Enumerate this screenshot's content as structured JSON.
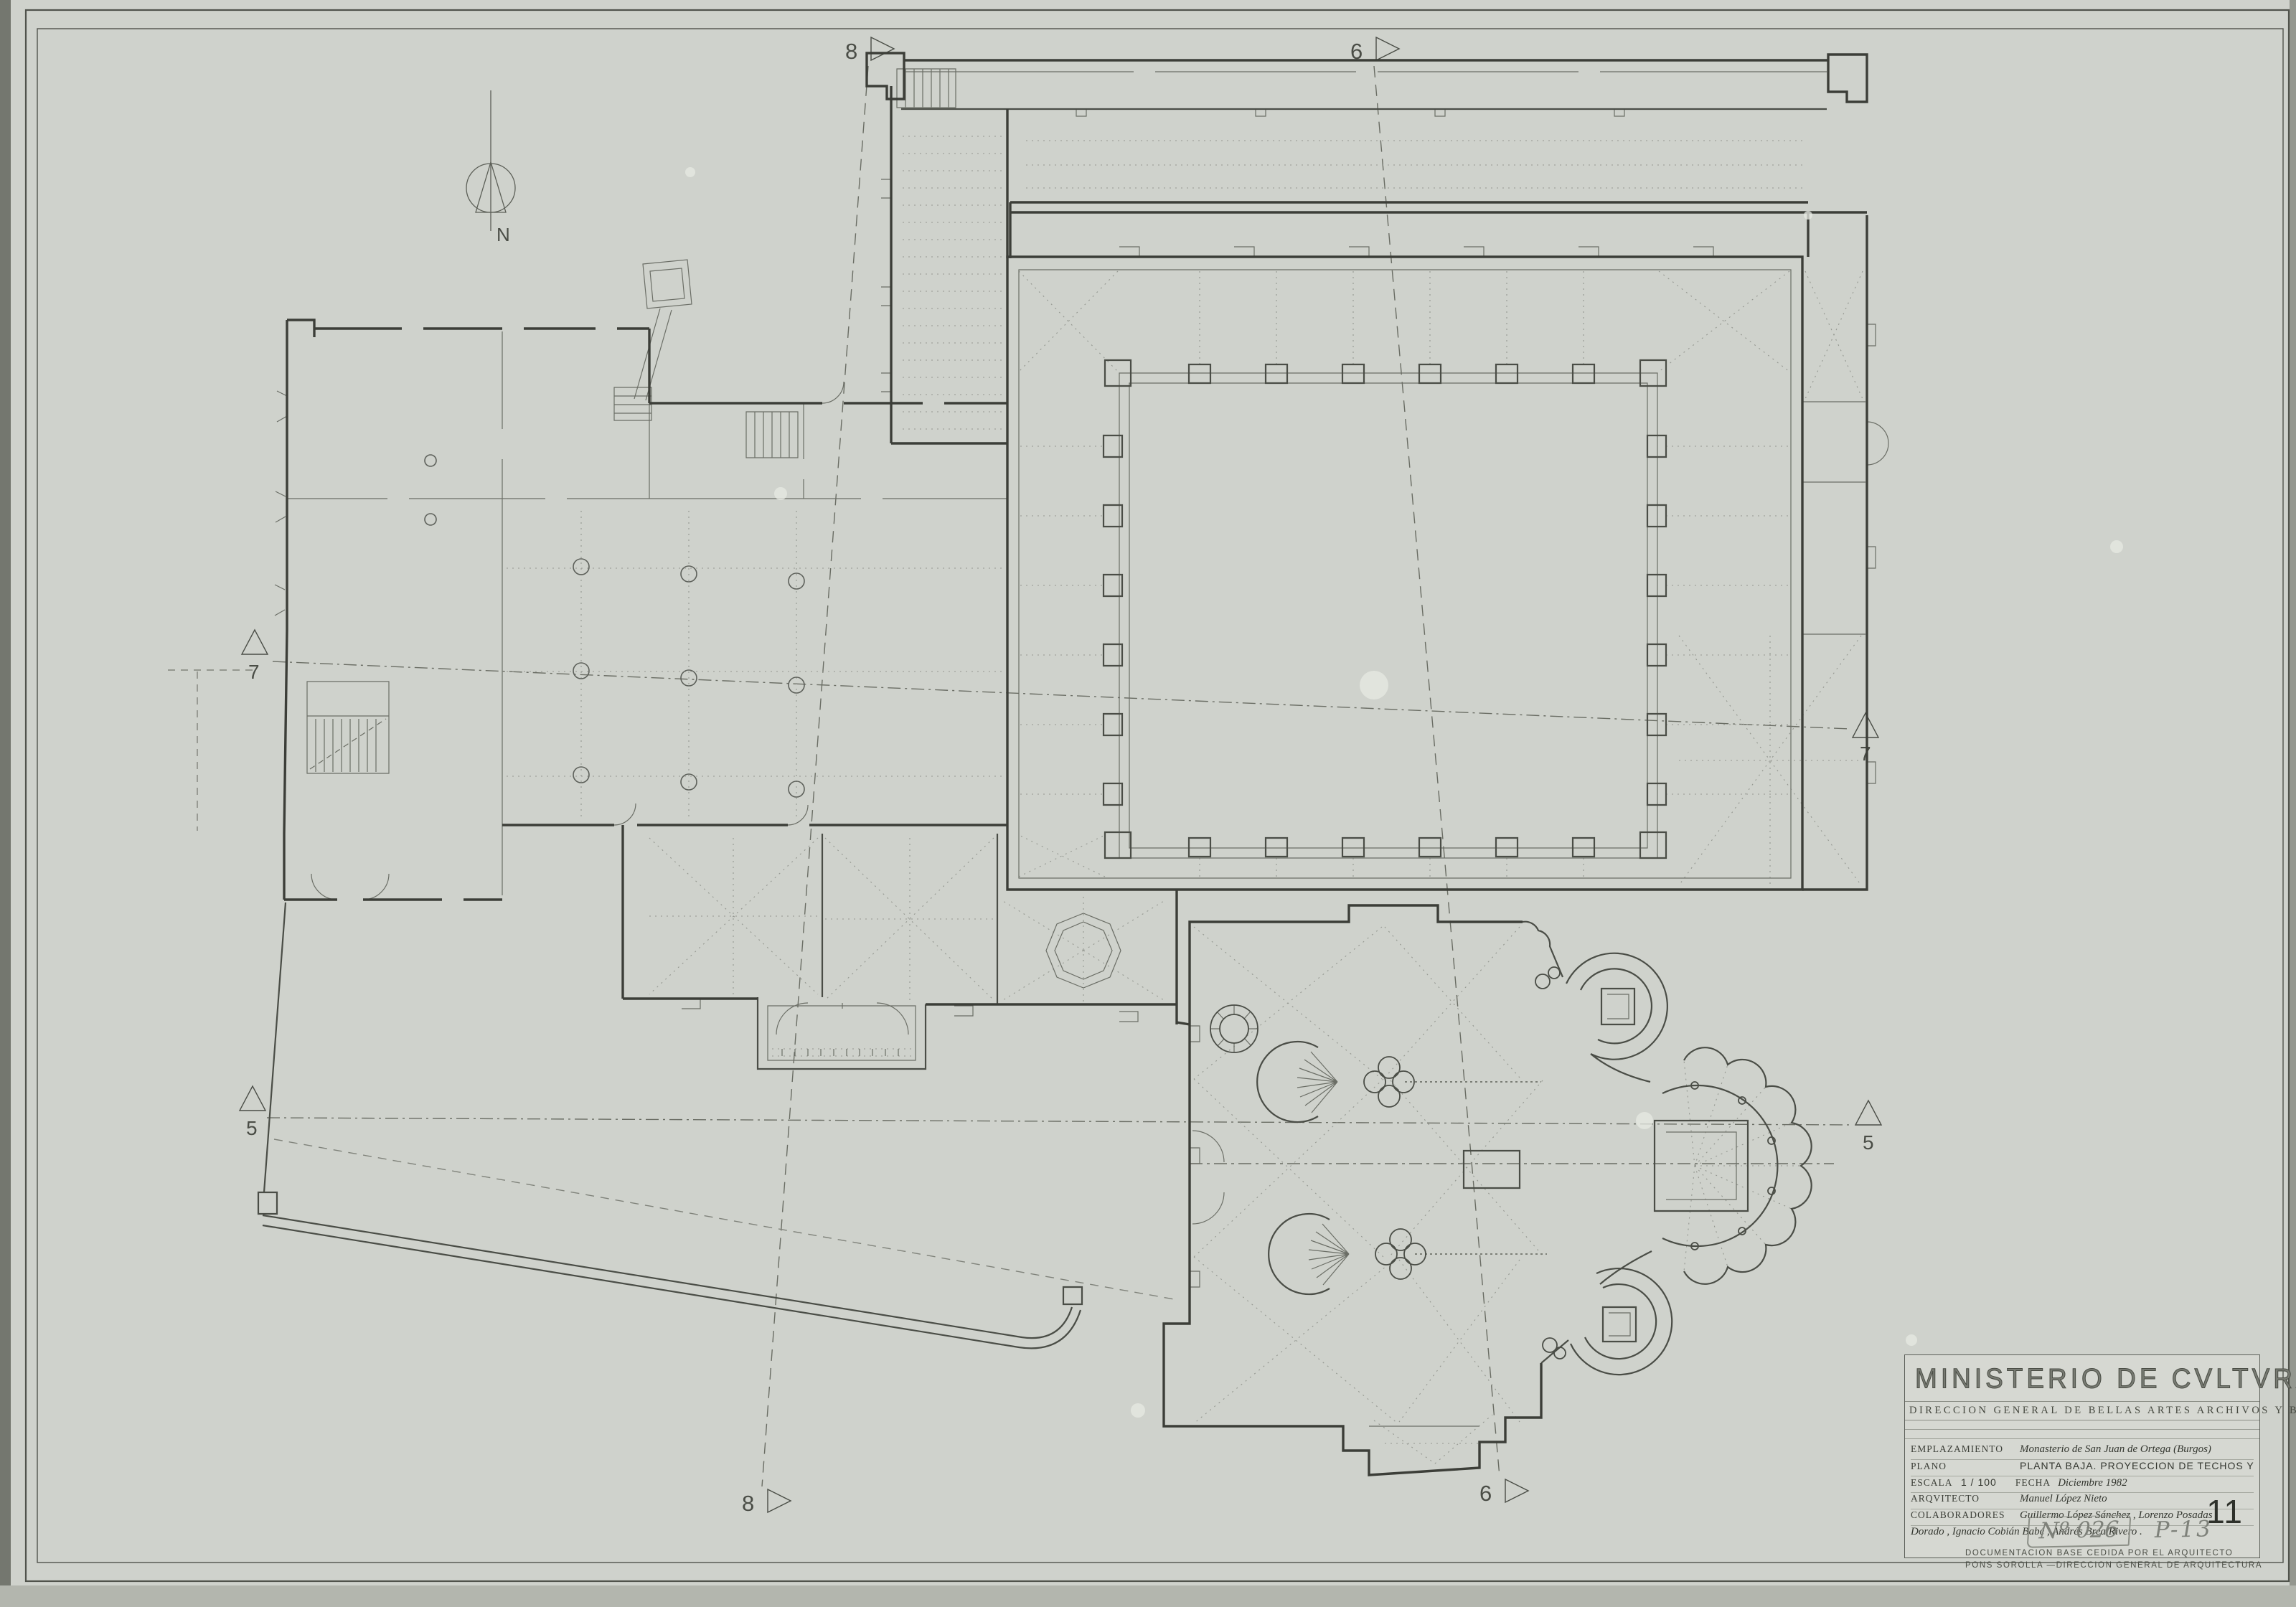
{
  "colors": {
    "paper": "#cfd2cc",
    "ink_wall": "#3c3e38",
    "ink_thin": "#6b6e66",
    "ink_dotted": "#949790",
    "ink_dash": "#5c5f57"
  },
  "compass": {
    "label": "N"
  },
  "markers": {
    "t8": "8",
    "t6": "6",
    "b8": "8",
    "b6": "6",
    "l7": "7",
    "r7": "7",
    "l5": "5",
    "r5": "5"
  },
  "title_block": {
    "ministry": "MINISTERIO DE CVLTVRA",
    "department": "DIRECCION GENERAL DE BELLAS ARTES ARCHIVOS Y BIBLIOTECAS",
    "emplazamiento_label": "EMPLAZAMIENTO",
    "emplazamiento_value": "Monasterio de San Juan de Ortega (Burgos)",
    "plano_label": "PLANO",
    "plano_value": "PLANTA BAJA. PROYECCION DE TECHOS Y BOVEDAS",
    "numero_label": "NVMERO",
    "numero_value": "11",
    "escala_label": "ESCALA",
    "escala_value": "1 / 100",
    "fecha_label": "FECHA",
    "fecha_value": "Diciembre 1982",
    "arquitecto_label": "ARQVITECTO",
    "arquitecto_value": "Manuel López Nieto",
    "colaboradores_label": "COLABORADORES",
    "colaboradores_value_line1": "Guillermo López Sánchez , Lorenzo Posadas",
    "colaboradores_value_line2": "Dorado , Ignacio Cobián Babé , Andrés Brea Rivero .",
    "footer_line1": "DOCUMENTACION BASE CEDIDA POR EL ARQUITECTO",
    "footer_line2": "PONS SOROLLA    —DIRECCION GENERAL DE ARQUITECTURA"
  },
  "handwritten": {
    "ref_number": "Nº 026",
    "page_ref": "P-13"
  }
}
